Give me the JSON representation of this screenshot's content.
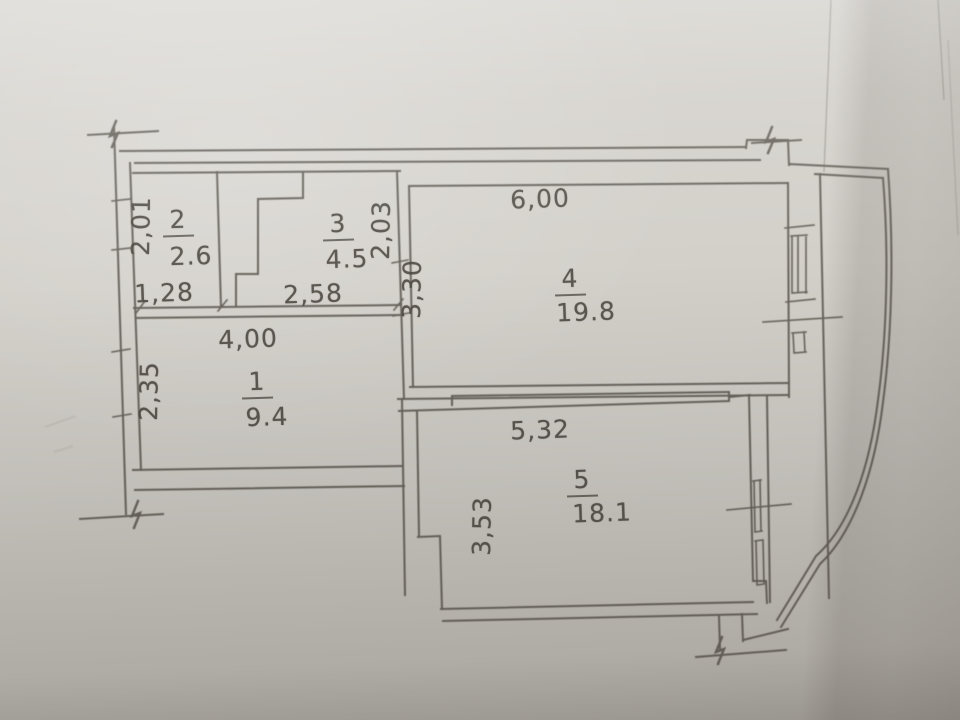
{
  "rooms": {
    "r1": {
      "number": "1",
      "area": "9.4"
    },
    "r2": {
      "number": "2",
      "area": "2.6"
    },
    "r3": {
      "number": "3",
      "area": "4.5"
    },
    "r4": {
      "number": "4",
      "area": "19.8"
    },
    "r5": {
      "number": "5",
      "area": "18.1"
    }
  },
  "dims": {
    "room1_width": "4,00",
    "room1_height": "2,35",
    "room2_width": "1,28",
    "room2_height": "2,01",
    "room3_width": "2,58",
    "room3_height": "2,03",
    "room4_width": "6,00",
    "room4_height": "3,30",
    "room5_width": "5,32",
    "room5_height": "3,53"
  },
  "colors": {
    "paper": "#d3d0ca",
    "ink": "#56524b"
  }
}
